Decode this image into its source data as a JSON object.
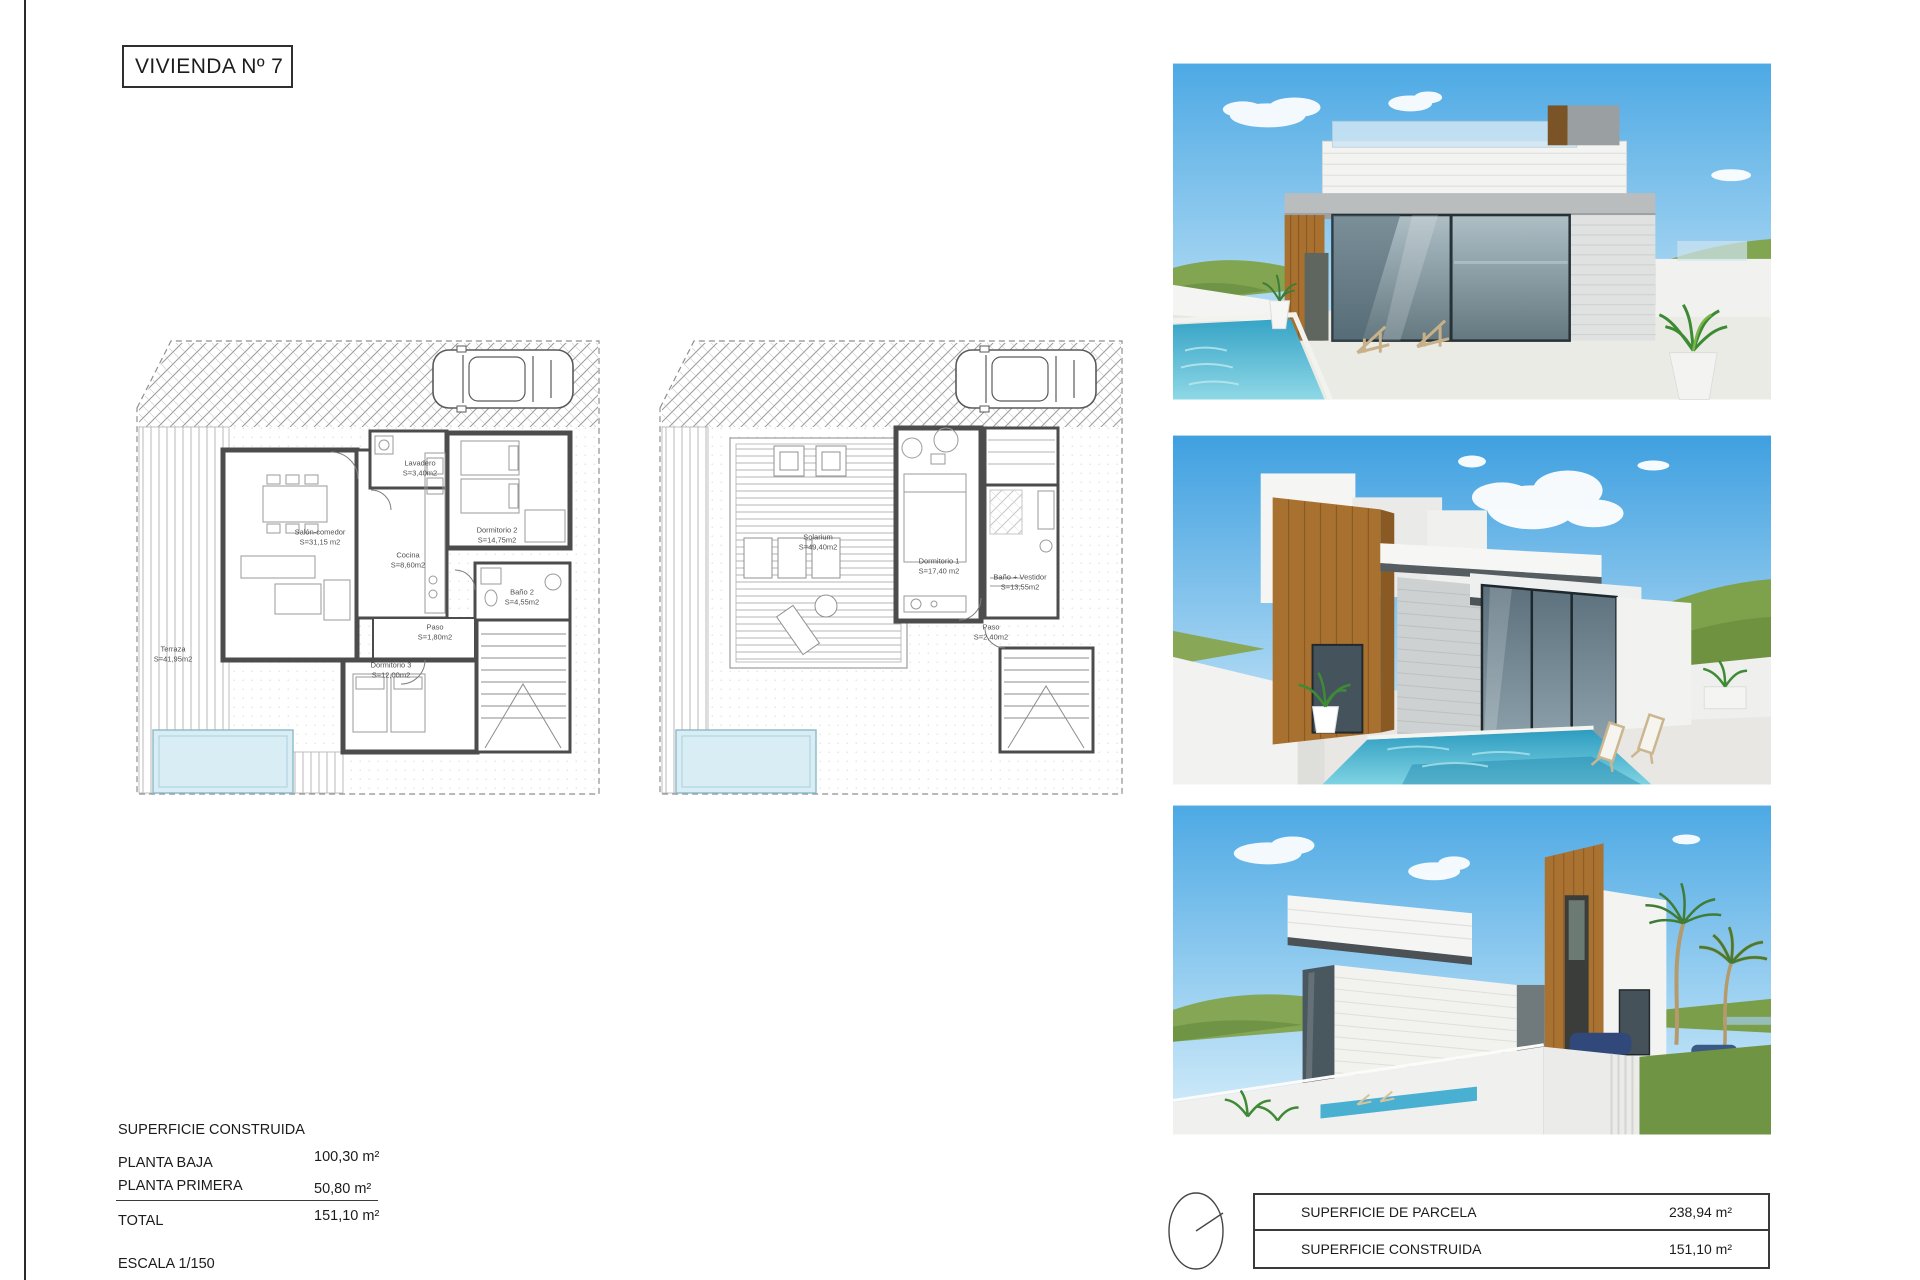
{
  "title": {
    "label": "VIVIENDA Nº 7"
  },
  "plans": {
    "planta_baja": {
      "rooms": [
        {
          "label": "Lavadero",
          "area": "S=3,40m2"
        },
        {
          "label": "Dormitorio 2",
          "area": "S=14,75m2"
        },
        {
          "label": "Salón-comedor",
          "area": "S=31,15 m2"
        },
        {
          "label": "Cocina",
          "area": "S=8,60m2"
        },
        {
          "label": "Baño 2",
          "area": "S=4,55m2"
        },
        {
          "label": "Paso",
          "area": "S=1,80m2"
        },
        {
          "label": "Dormitorio 3",
          "area": "S=12,00m2"
        },
        {
          "label": "Terraza",
          "area": "S=41,95m2"
        }
      ]
    },
    "planta_primera": {
      "rooms": [
        {
          "label": "Solarium",
          "area": "S=49,40m2"
        },
        {
          "label": "Dormitorio 1",
          "area": "S=17,40 m2"
        },
        {
          "label": "Baño + Vestidor",
          "area": "S=13,55m2"
        },
        {
          "label": "Paso",
          "area": "S=2,40m2"
        }
      ]
    }
  },
  "summary": {
    "heading": "SUPERFICIE CONSTRUIDA",
    "rows": [
      {
        "label": "PLANTA BAJA",
        "value": "100,30 m²"
      },
      {
        "label": "PLANTA PRIMERA",
        "value": "50,80 m²"
      }
    ],
    "total": {
      "label": "TOTAL",
      "value": "151,10 m²"
    },
    "scale": "ESCALA 1/150"
  },
  "info_table": {
    "rows": [
      {
        "label": "SUPERFICIE DE PARCELA",
        "value": "238,94 m²"
      },
      {
        "label": "SUPERFICIE CONSTRUIDA",
        "value": "151,10 m²"
      }
    ]
  },
  "colors": {
    "wood_accent": "#a9712f",
    "render_pool": "#2f9fc4",
    "plan_pool": "#d9edf4",
    "sky": "#4da9e4",
    "hills": "#7fa34f"
  }
}
